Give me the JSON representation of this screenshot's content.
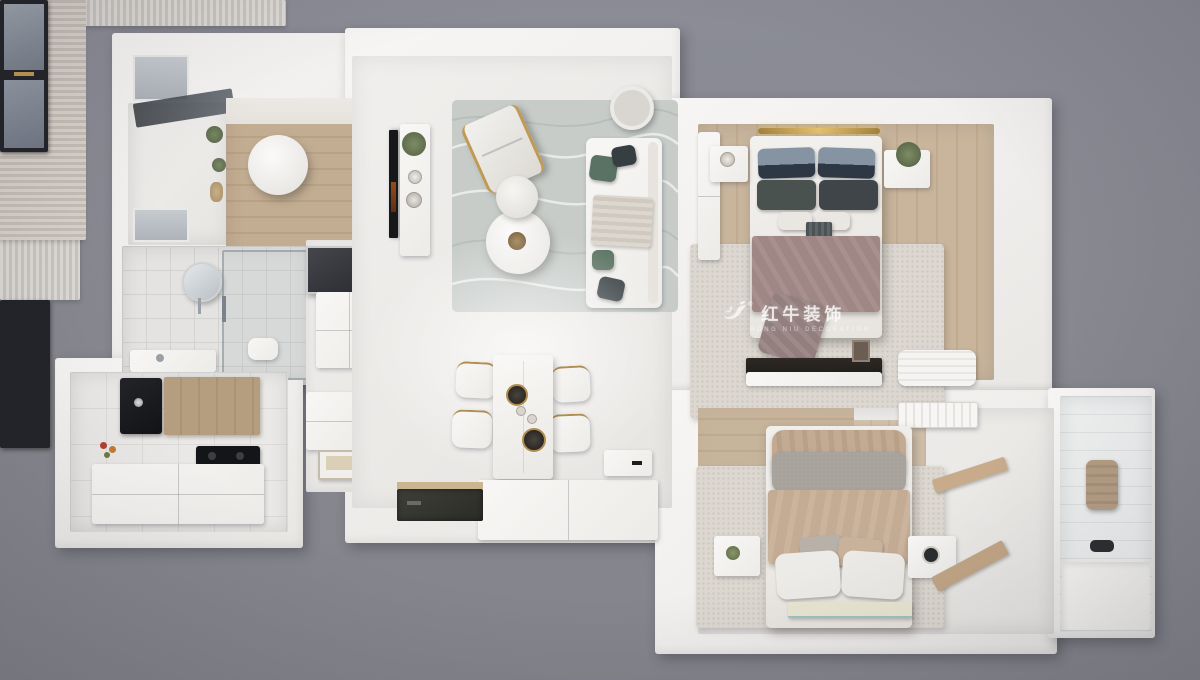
{
  "scene": {
    "description": "Top-down 3D render of a furnished apartment floor plan on a gray backdrop",
    "background_color": "#87878f"
  },
  "watermark": {
    "logo_icon": "bull-logo",
    "registered_mark": "®",
    "brand_text": "红牛装饰",
    "subtitle_text": "HONG NIU DECORATION",
    "text_color": "#ffffff"
  },
  "palette": {
    "wall_white": "#f2f1ee",
    "floor_light": "#ecebe9",
    "wood_floor": "#c3ae92",
    "living_rug": "#c9cecb",
    "bedroom_rug": "#dcd8d1",
    "curtain": "#d8d4d0",
    "window_frame": "#212227",
    "window_glass": "#8d949e",
    "mauve_blanket": "#9e8785",
    "beige_blanket": "#c3ab94",
    "sage_pillow": "#5a7263",
    "charcoal_pillow": "#3a4246",
    "gold_accent": "#c7a050",
    "appliance_black": "#17181a"
  },
  "rooms": [
    {
      "name": "balcony",
      "furniture": [
        "black-frame-window",
        "glass-canopy",
        "plants"
      ]
    },
    {
      "name": "study",
      "furniture": [
        "wood-floor",
        "round-table"
      ]
    },
    {
      "name": "bathroom",
      "furniture": [
        "window",
        "round-mirror",
        "shower-enclosure",
        "toilet"
      ]
    },
    {
      "name": "hallway",
      "furniture": [
        "wall-mirror",
        "storage-cabinets",
        "tray"
      ]
    },
    {
      "name": "kitchen",
      "furniture": [
        "window",
        "black-sink",
        "wood-countertop",
        "cooktop",
        "island",
        "fruit"
      ]
    },
    {
      "name": "living-room",
      "furniture": [
        "curtains",
        "window",
        "tv",
        "media-console",
        "area-rug",
        "lounge-chair",
        "nesting-coffee-tables",
        "sofa",
        "throw-pillows",
        "side-stool"
      ]
    },
    {
      "name": "dining-room",
      "furniture": [
        "dining-table",
        "chairs",
        "plates",
        "sideboard"
      ]
    },
    {
      "name": "entry",
      "furniture": [
        "door-mat",
        "shoe-cabinet"
      ]
    },
    {
      "name": "master-bedroom",
      "furniture": [
        "headboard-light",
        "double-bed",
        "pillows",
        "mauve-blanket",
        "nightstands",
        "plant",
        "area-rug",
        "wardrobe",
        "curtains",
        "bay-window",
        "desk",
        "bench"
      ]
    },
    {
      "name": "second-bedroom",
      "furniture": [
        "air-conditioner",
        "double-bed",
        "beige-blanket",
        "pillows",
        "nightstands",
        "area-rug",
        "foot-mat",
        "louvered-wardrobe",
        "wood-floor"
      ]
    },
    {
      "name": "second-bathroom",
      "furniture": [
        "black-frame-window",
        "towel",
        "toilet-area",
        "step"
      ]
    }
  ]
}
